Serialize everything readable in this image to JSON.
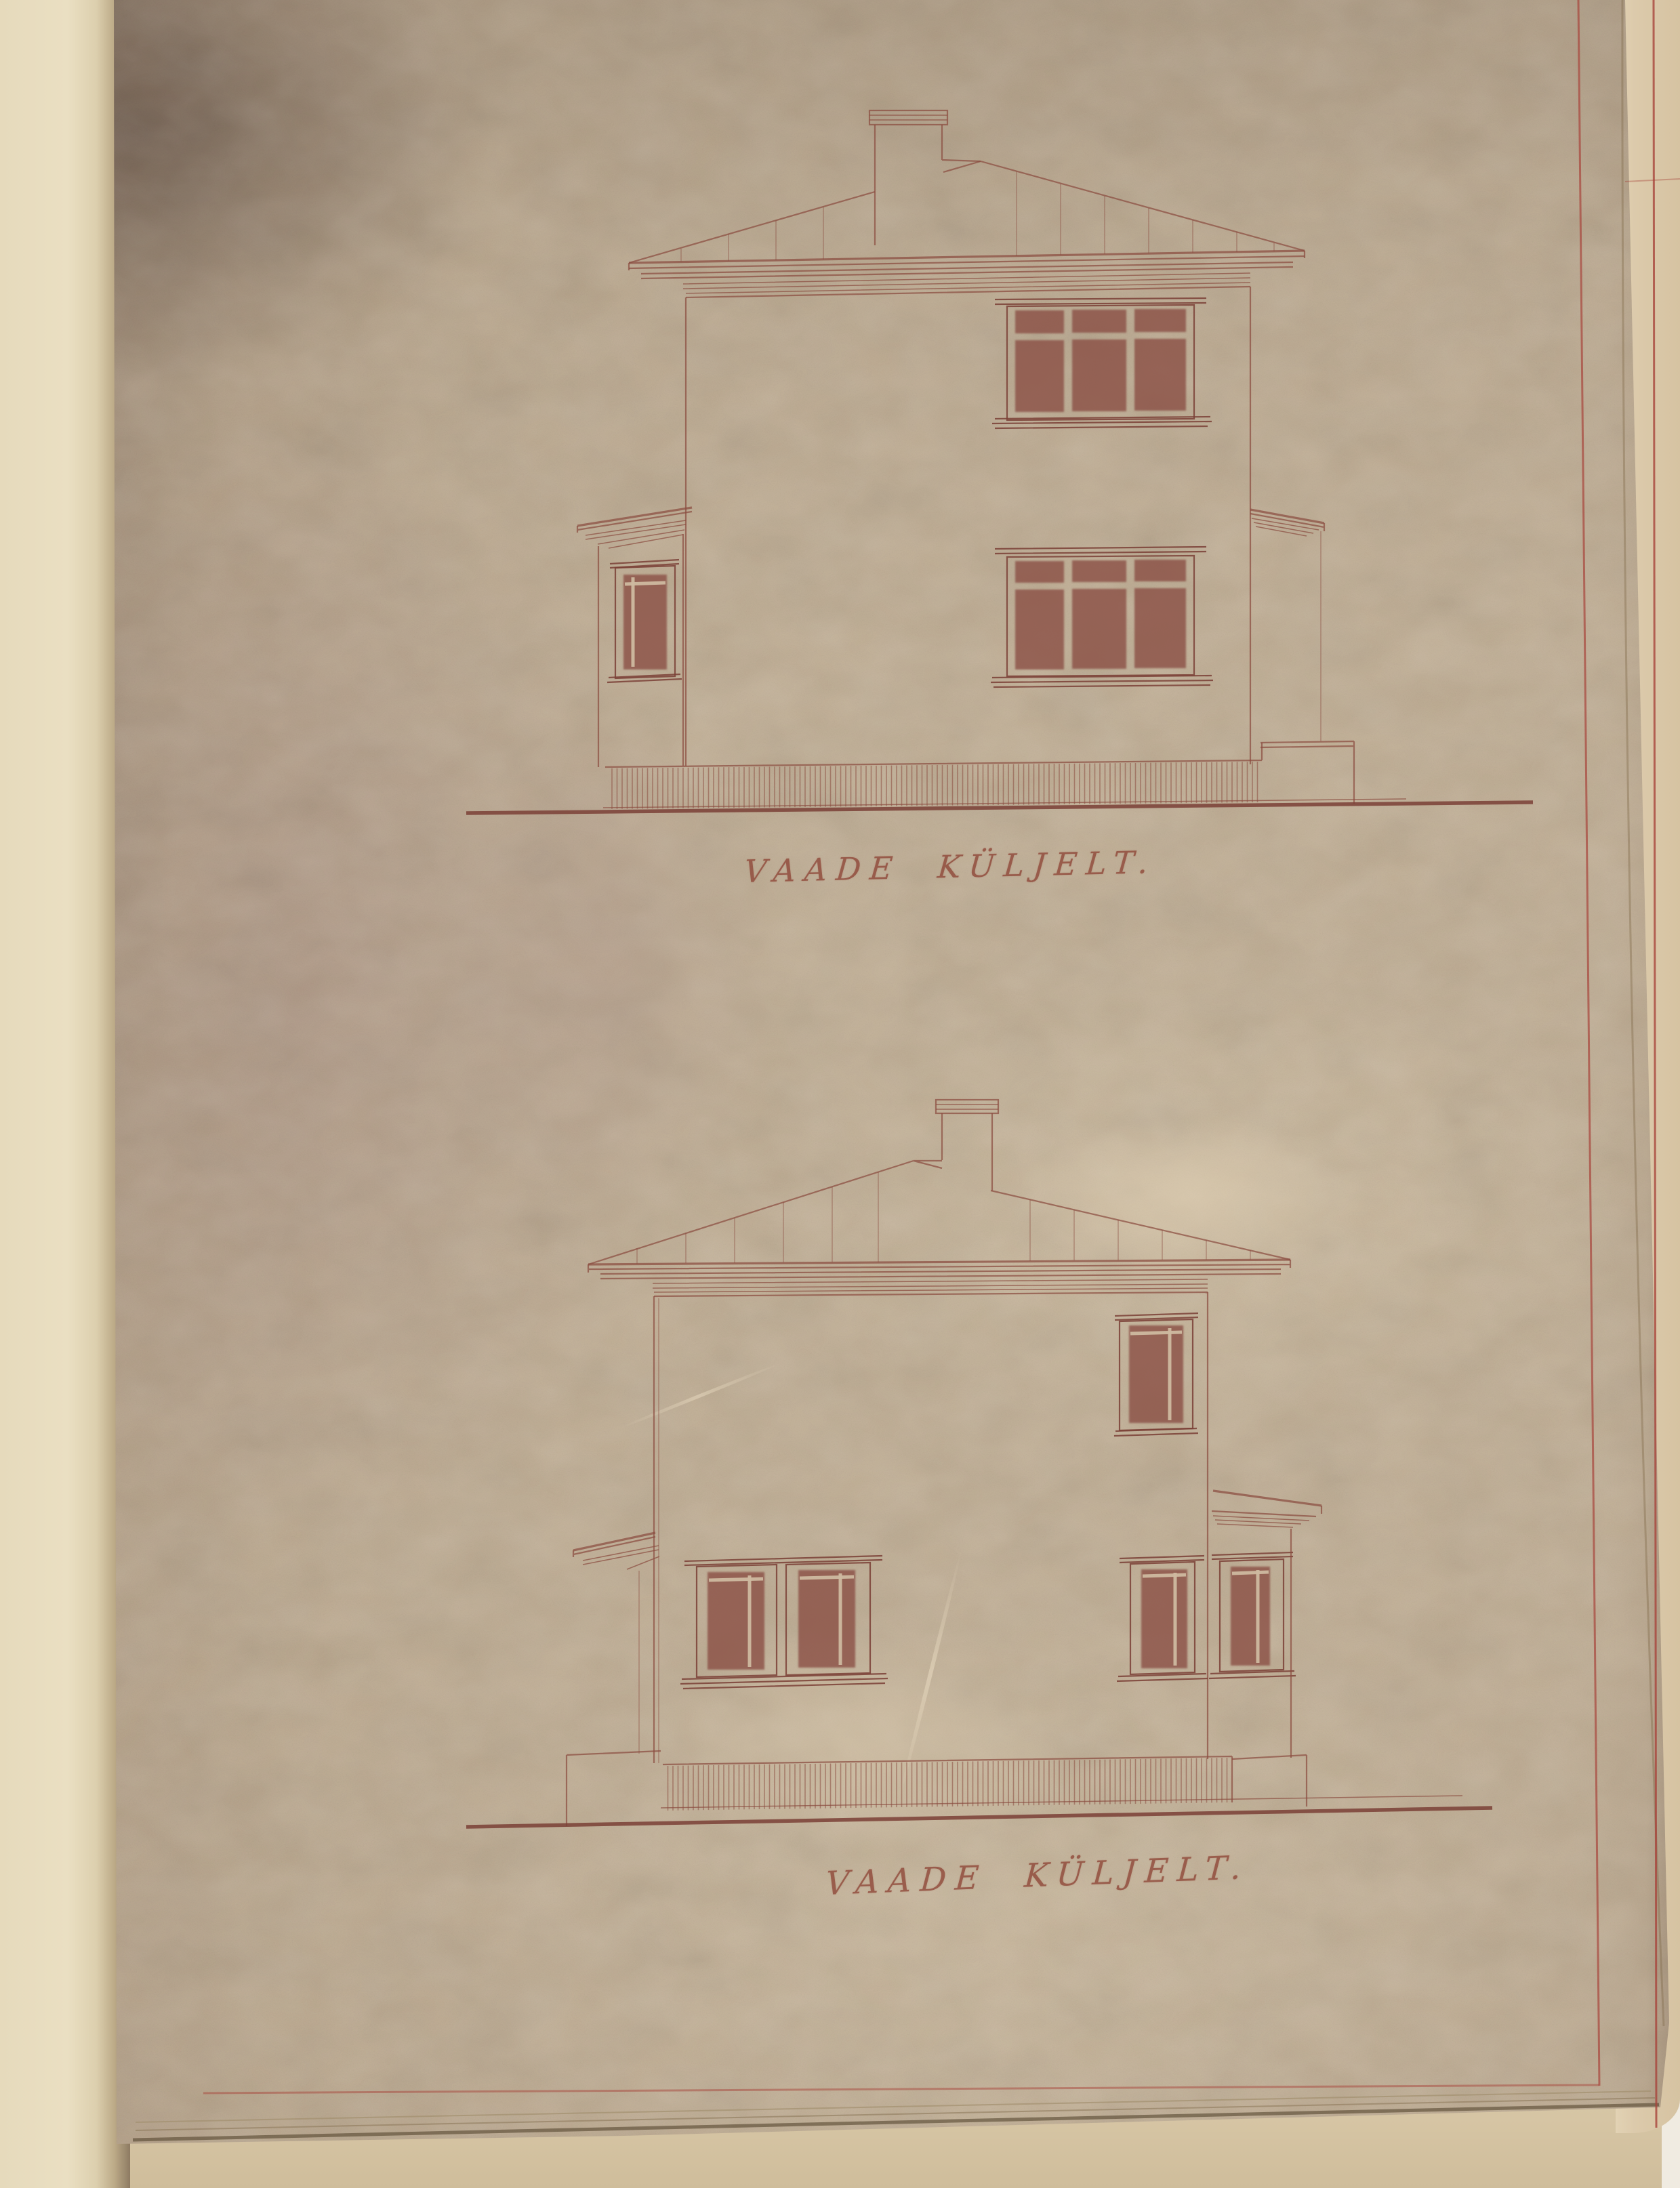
{
  "captions": {
    "top": {
      "text": "VAADE KÜLJELT."
    },
    "bottom": {
      "text": "VAADE KÜLJELT."
    }
  },
  "colors": {
    "ink": "#8a4c40",
    "ink_dark": "#7a4036",
    "window_fill": "#8b5045",
    "paper_light": "#cdb9a0",
    "caption_ink": "#8e4536",
    "border_red": "#a8453c",
    "sheet_base": "#c2b096",
    "book_page": "#e8ddbf",
    "under_page": "#dccaab",
    "scan_bg": "#f0ebe1"
  }
}
